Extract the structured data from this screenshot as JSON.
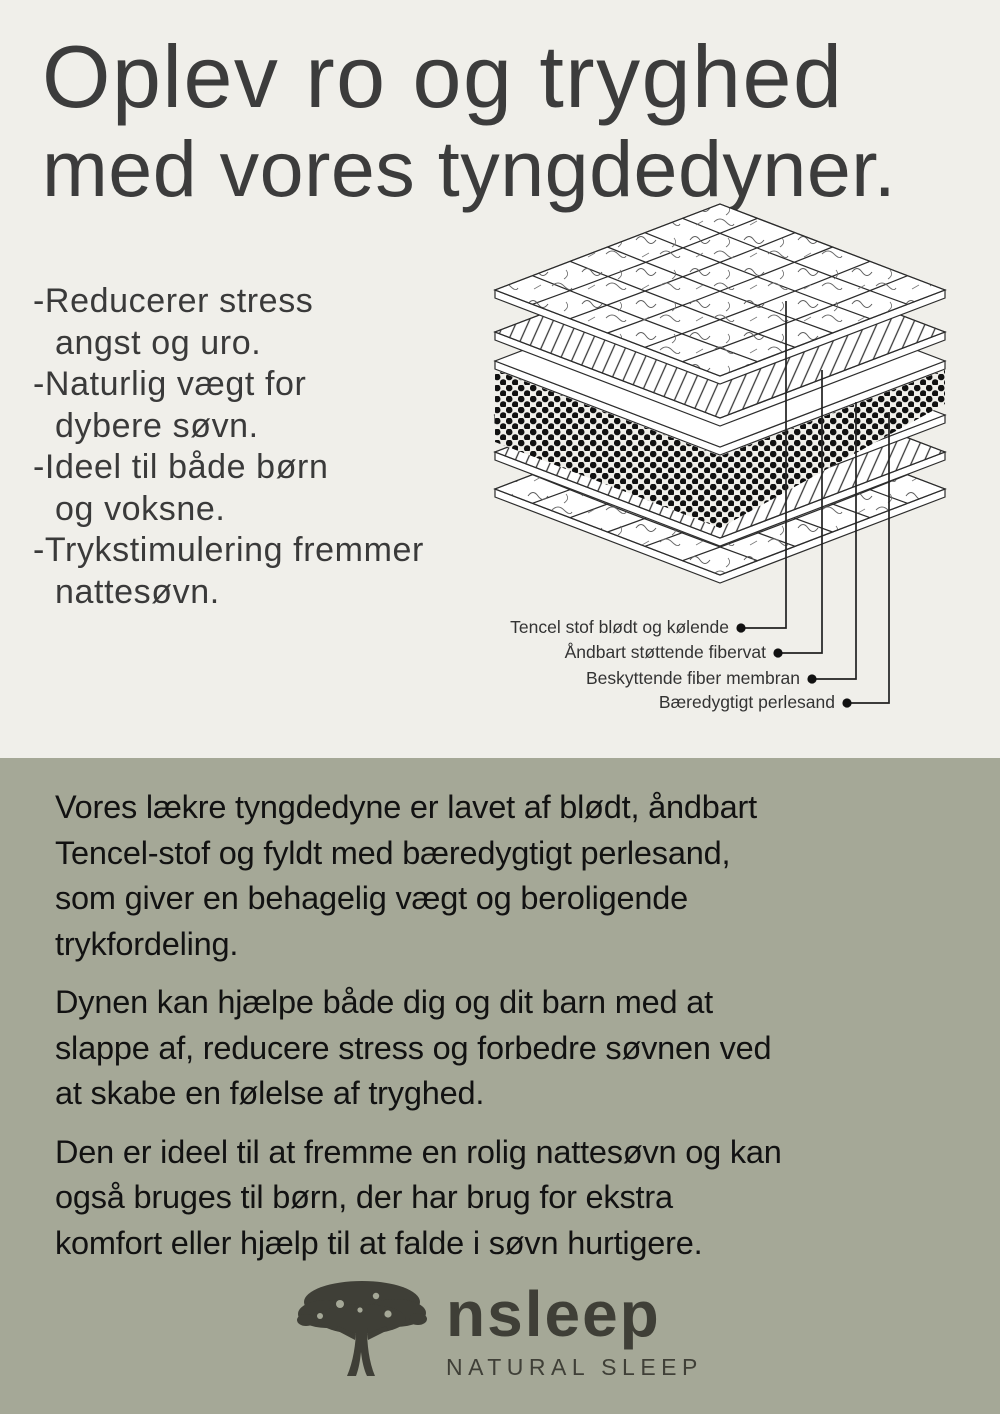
{
  "colors": {
    "top_bg": "#f0efea",
    "bottom_bg": "#a5a897",
    "headline_text": "#3c3c3c",
    "body_text": "#121212",
    "logo": "#3f3f37"
  },
  "header": {
    "line1": "Oplev ro og tryghed",
    "line2": "med vores tyngdedyner."
  },
  "benefits": {
    "lines": [
      "-Reducerer stress",
      "angst og uro.",
      "-Naturlig vægt for",
      "dybere søvn.",
      "-Ideel til både børn",
      "og voksne.",
      "-Trykstimulering fremmer",
      "nattesøvn."
    ]
  },
  "diagram": {
    "layers": [
      "tencel-fabric",
      "fiber-batting",
      "membrane",
      "pearl-sand",
      "membrane",
      "fiber-batting",
      "tencel-fabric"
    ],
    "labels": [
      "Tencel stof blødt og kølende",
      "Åndbart støttende fibervat",
      "Beskyttende fiber membran",
      "Bæredygtigt perlesand"
    ]
  },
  "body": {
    "paragraphs": [
      "Vores lækre tyngdedyne er lavet af blødt, åndbart\nTencel-stof og fyldt med bæredygtigt perlesand,\nsom giver en behagelig vægt og beroligende\ntrykfordeling.",
      "Dynen kan hjælpe både dig og dit barn med at\nslappe af, reducere stress og forbedre søvnen ved\nat skabe en følelse af tryghed.",
      "Den er ideel til at fremme en rolig nattesøvn og kan\nogså bruges til børn, der har brug for ekstra\nkomfort eller hjælp til at falde i søvn hurtigere."
    ]
  },
  "logo": {
    "brand": "nsleep",
    "tagline": "NATURAL SLEEP"
  }
}
